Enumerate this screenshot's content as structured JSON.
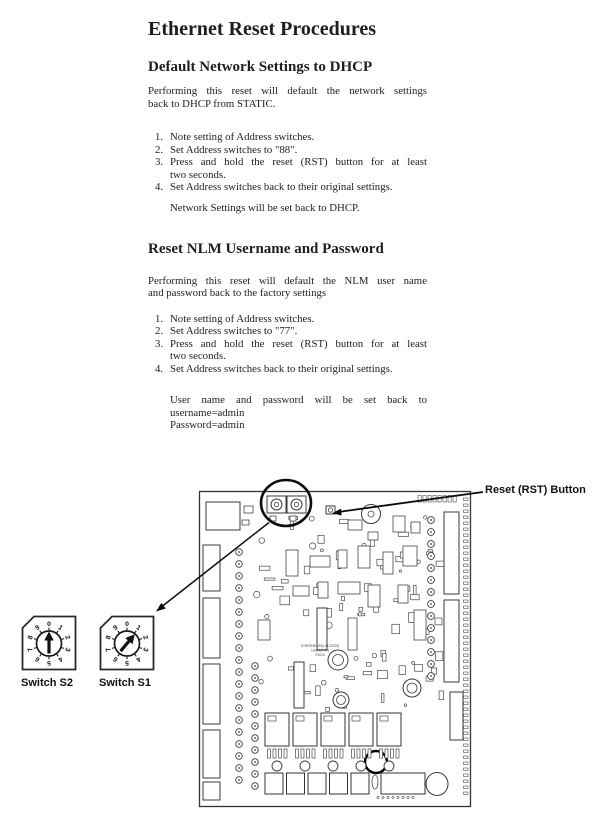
{
  "colors": {
    "paper": "#ffffff",
    "ink": "#1e1e1e"
  },
  "doc": {
    "title": "Ethernet Reset Procedures",
    "sections": [
      {
        "heading": "Default Network Settings to DHCP",
        "intro_lines": [
          "Performing this reset will default the network settings",
          "back to DHCP from STATIC."
        ],
        "steps": [
          {
            "lines": [
              "Note setting of Address switches."
            ]
          },
          {
            "lines": [
              "Set Address switches to \"88\"."
            ]
          },
          {
            "lines": [
              "Press and hold the reset (RST) button for at least",
              "two seconds."
            ]
          },
          {
            "lines": [
              "Set Address switches back to their original settings."
            ]
          }
        ],
        "result_lines": [
          "Network Settings will be set back to DHCP."
        ]
      },
      {
        "heading": "Reset NLM Username and Password",
        "intro_lines": [
          "Performing this reset will default the NLM user name",
          "and password back to the factory settings"
        ],
        "steps": [
          {
            "lines": [
              "Note setting of Address switches."
            ]
          },
          {
            "lines": [
              "Set Address switches to \"77\"."
            ]
          },
          {
            "lines": [
              "Press and hold the reset (RST) button for at least",
              "two seconds."
            ]
          },
          {
            "lines": [
              "Set Address switches back to their original settings."
            ]
          }
        ],
        "result_lines": [
          "User name and password will be set back to",
          "username=admin",
          "Password=admin"
        ]
      }
    ]
  },
  "figure": {
    "reset_button_label": "Reset (RST) Button",
    "switch_s2_label": "Switch S2",
    "switch_s1_label": "Switch S1",
    "dial_digits": [
      "0",
      "1",
      "2",
      "3",
      "4",
      "5",
      "6",
      "7",
      "8",
      "9"
    ],
    "board_text_lines": [
      "CONTINENTAL ACCESS",
      "CA3XMPGR",
      "©2014"
    ]
  }
}
